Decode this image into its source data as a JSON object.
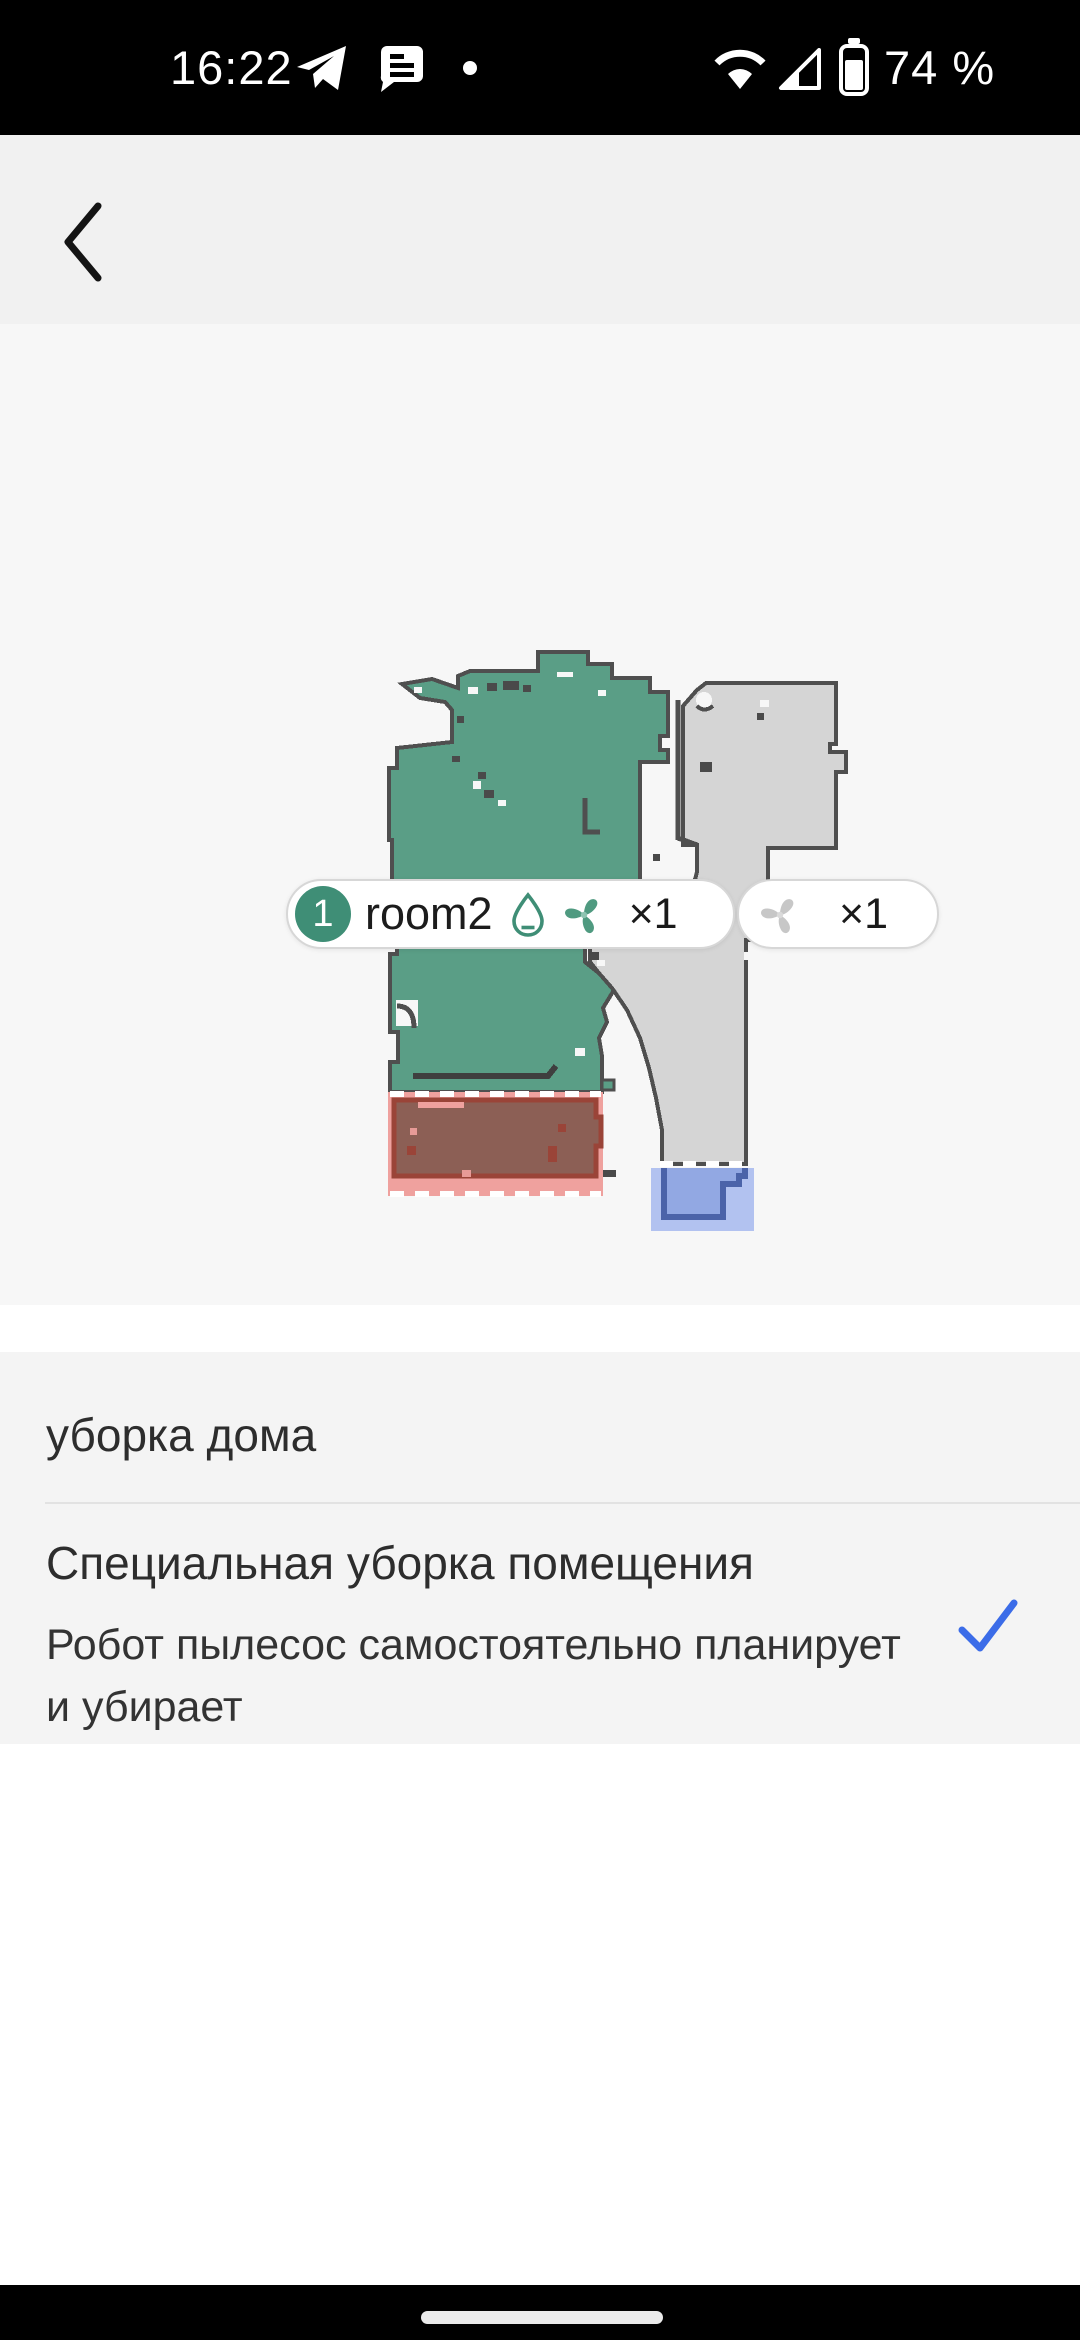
{
  "status_bar": {
    "time": "16:22",
    "battery_percent": "74 %"
  },
  "header": {
    "title": "Пожалуйста, выбе…"
  },
  "map": {
    "labels": [
      {
        "room_index": "1",
        "room_name": "room2",
        "count": "×1",
        "icons": [
          "water-drop-icon",
          "fan-icon"
        ]
      },
      {
        "count": "×1",
        "icons": [
          "fan-icon"
        ]
      }
    ],
    "colors": {
      "room_selected": "#5a9e86",
      "room_unselected": "#d5d5d5",
      "wall": "#4f4f4f",
      "restricted_zone": "#efa19e",
      "restricted_zone_inner": "#8c5f55",
      "dock_zone": "#b2c2f0",
      "dock_zone_inner": "#92a8e3"
    }
  },
  "options": [
    {
      "title": "уборка дома",
      "selected": false
    },
    {
      "title": "Специальная уборка помещения",
      "subtitle": "Робот пылесос самостоятельно планирует и убирает",
      "selected": true
    }
  ],
  "accent": {
    "checkmark_color": "#3b6ce8"
  }
}
